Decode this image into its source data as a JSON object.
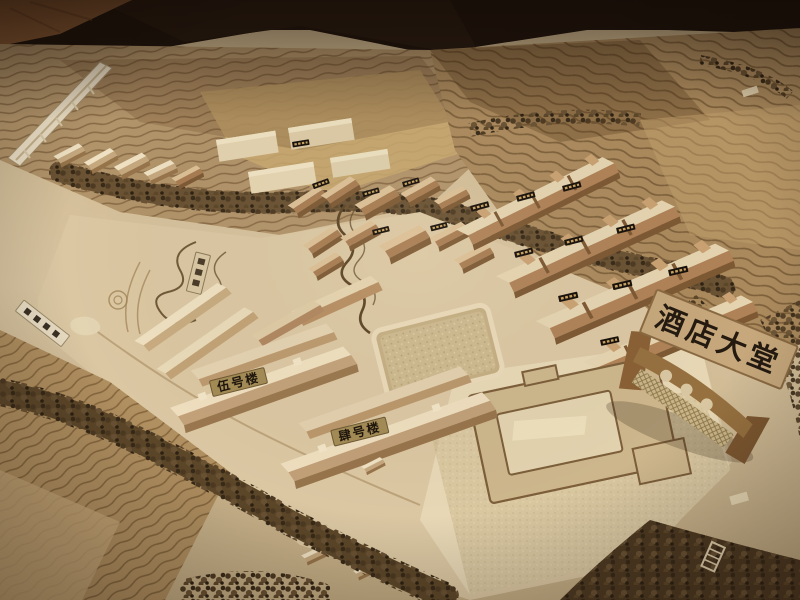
{
  "photo": {
    "type": "photograph of a wooden architectural scale model",
    "scene": "Sand-table model of a hillside resort: terraced slopes, tree belts, village houses, row houses, labelled guest buildings and a hotel lobby site marked by an arch sign",
    "lighting": "warm indoor tungsten light, dark tabletop background at top"
  },
  "signs": {
    "hotel_lobby": {
      "text": "酒店大堂"
    },
    "building_five": {
      "text": "伍号楼"
    },
    "building_four": {
      "text": "肆号楼"
    }
  },
  "palette": {
    "background_dark": "#1f150e",
    "wood_floor": "#8f5e36",
    "board_tan": "#d2bd97",
    "terrace_brown": "#a98a5e",
    "contour_line": "#7a5c38",
    "tree_dark": "#57422a",
    "building_pale": "#e9dabb",
    "building_brown": "#b58a60",
    "plaque_dark": "#17100a",
    "plaque_gold": "#c9a35f",
    "sign_tan": "#c7a87c",
    "sign_text": "#241a10"
  }
}
